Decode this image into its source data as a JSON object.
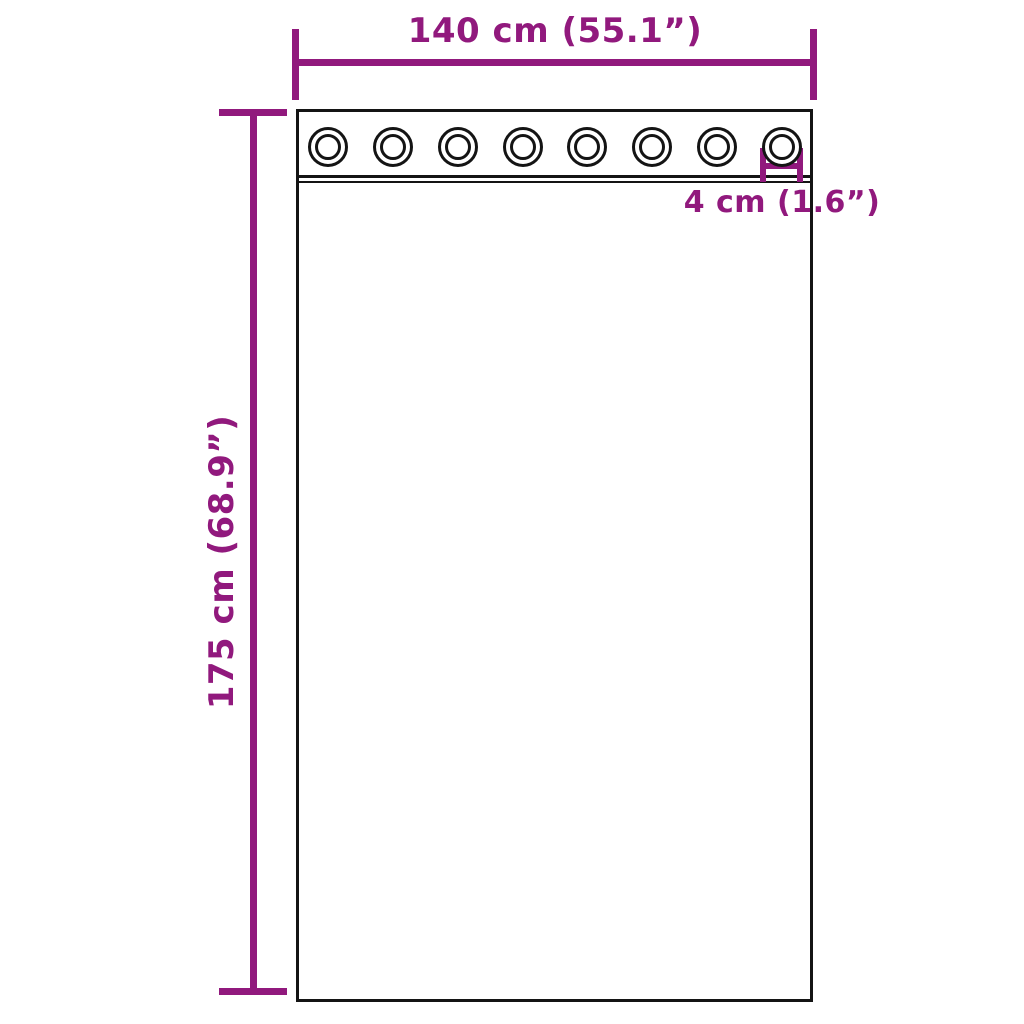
{
  "accent_color": "#91197d",
  "line_color": "#141414",
  "background_color": "#ffffff",
  "diagram": {
    "subject": "curtain-with-grommets-dimension-diagram",
    "grommet_count": 8,
    "width_dimension": {
      "label": "140 cm (55.1”)"
    },
    "height_dimension": {
      "label": "175 cm (68.9”)"
    },
    "grommet_dimension": {
      "label": "4 cm (1.6”)"
    }
  }
}
